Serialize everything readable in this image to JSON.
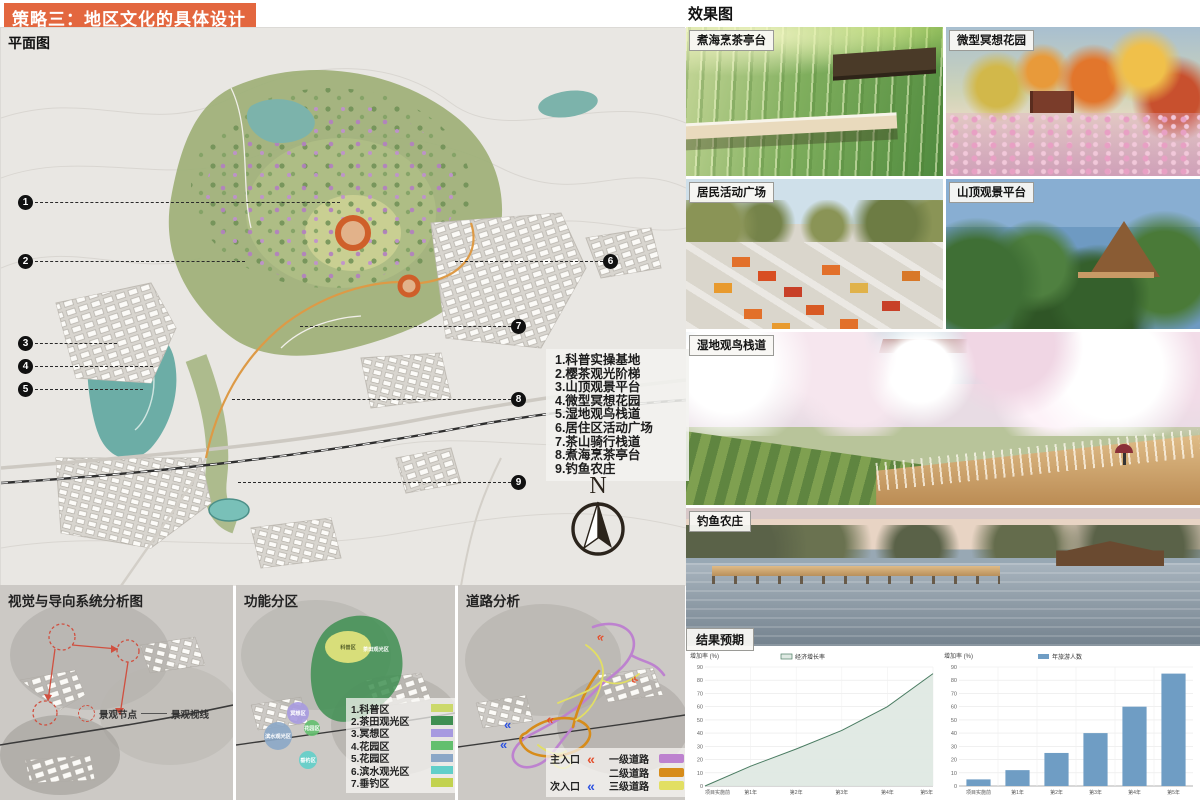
{
  "header": {
    "title": "策略三：地区文化的具体设计",
    "bg_color": "#e3673f"
  },
  "plan_map": {
    "label": "平面图",
    "list_items": [
      "1.科普实操基地",
      "2.樱茶观光阶梯",
      "3.山顶观景平台",
      "4.微型冥想花园",
      "5.湿地观鸟栈道",
      "6.居住区活动广场",
      "7.茶山骑行栈道",
      "8.煮海烹茶亭台",
      "9.钓鱼农庄"
    ],
    "markers": [
      "1",
      "2",
      "3",
      "4",
      "5",
      "6",
      "7",
      "8",
      "9"
    ],
    "compass_label": "N"
  },
  "analysis": {
    "visual_map": {
      "title": "视觉与导向系统分析图",
      "legend_node": "景观节点",
      "legend_sight": "景观视线"
    },
    "zoning_map": {
      "title": "功能分区",
      "legend": [
        {
          "label": "1.科普区",
          "color": "#ccd96b"
        },
        {
          "label": "2.茶田观光区",
          "color": "#3f8f52"
        },
        {
          "label": "3.冥想区",
          "color": "#a79ae0"
        },
        {
          "label": "4.花园区",
          "color": "#63bf6e"
        },
        {
          "label": "5.花园区",
          "color": "#8ba7c7"
        },
        {
          "label": "6.滨水观光区",
          "color": "#62cfc9"
        },
        {
          "label": "7.垂钓区",
          "color": "#c2d24f"
        }
      ],
      "map_labels": [
        "茶田观光区",
        "科普区",
        "冥想区",
        "花园区",
        "滨水观光区",
        "垂钓区"
      ]
    },
    "road_map": {
      "title": "道路分析",
      "entrances": [
        {
          "label": "主入口",
          "icon": "«",
          "color": "#e4502e"
        },
        {
          "label": "次入口",
          "icon": "«",
          "color": "#2d52e0"
        }
      ],
      "roads": [
        {
          "label": "一级道路",
          "color": "#bd82cf"
        },
        {
          "label": "二级道路",
          "color": "#d78c1a"
        },
        {
          "label": "三级道路",
          "color": "#e2df63"
        }
      ]
    }
  },
  "renders": {
    "header": "效果图",
    "items": [
      {
        "label": "煮海烹茶亭台"
      },
      {
        "label": "微型冥想花园"
      },
      {
        "label": "居民活动广场"
      },
      {
        "label": "山顶观景平台"
      },
      {
        "label": "湿地观鸟栈道"
      },
      {
        "label": "钓鱼农庄"
      }
    ]
  },
  "results": {
    "header": "结果预期"
  },
  "chart_data": [
    {
      "type": "area",
      "legend": "经济增长率",
      "categories": [
        "项目实施前",
        "第1年",
        "第2年",
        "第3年",
        "第4年",
        "第5年"
      ],
      "values": [
        0,
        15,
        28,
        42,
        60,
        85
      ],
      "ylabel": "增加率 (%)",
      "ylim": [
        0,
        90
      ],
      "yticks": [
        0,
        10,
        20,
        30,
        40,
        50,
        60,
        70,
        80,
        90
      ],
      "grid": true,
      "legend_position": "top",
      "line_color": "#4a7c62",
      "fill_color": "#dfe9e3"
    },
    {
      "type": "bar",
      "legend": "年旅游人数",
      "categories": [
        "项目实施前",
        "第1年",
        "第2年",
        "第3年",
        "第4年",
        "第5年"
      ],
      "values": [
        5,
        12,
        25,
        40,
        60,
        85
      ],
      "ylabel": "增加率 (%)",
      "ylim": [
        0,
        90
      ],
      "yticks": [
        0,
        10,
        20,
        30,
        40,
        50,
        60,
        70,
        80,
        90
      ],
      "grid": true,
      "legend_position": "top",
      "bar_color": "#6f9dc4"
    }
  ]
}
